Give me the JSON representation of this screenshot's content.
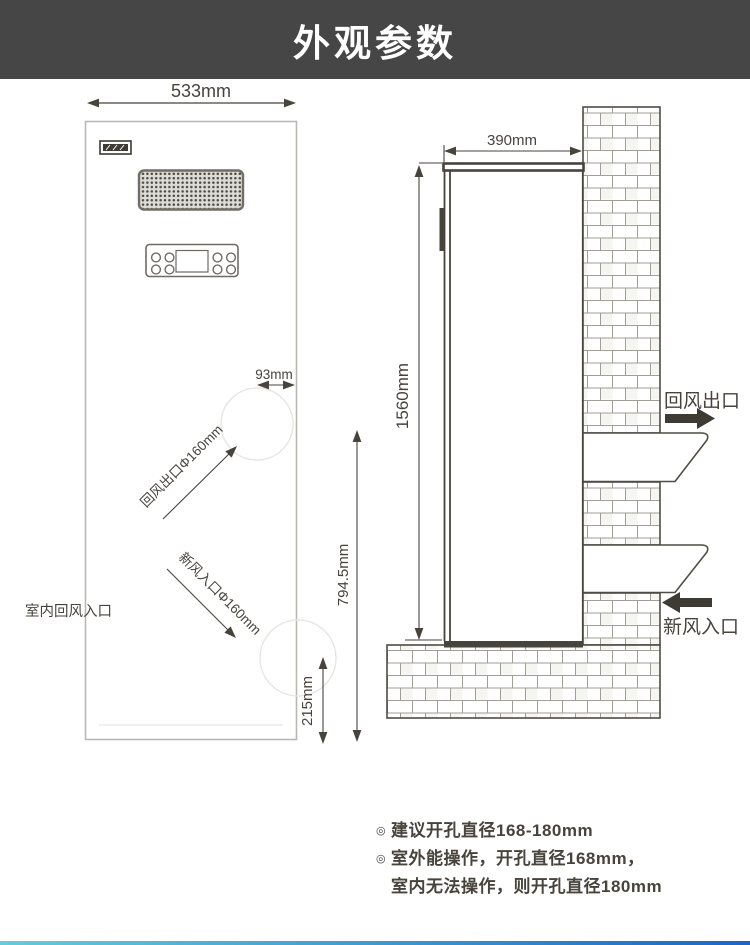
{
  "header": {
    "title": "外观参数"
  },
  "front_view": {
    "width_dim": "533mm",
    "hole_offset_dim": "93mm",
    "return_outlet_label": "回风出口Φ160mm",
    "fresh_inlet_label": "新风入口Φ160mm",
    "indoor_return_label": "室内回风入口",
    "hole_center_height_dim": "794.5mm",
    "bottom_hole_dim": "215mm"
  },
  "side_view": {
    "depth_dim": "390mm",
    "height_dim": "1560mm",
    "return_outlet_label": "回风出口",
    "fresh_inlet_label": "新风入口"
  },
  "notes": [
    {
      "bullet": "◎",
      "text": "建议开孔直径168-180mm"
    },
    {
      "bullet": "◎",
      "text": "室外能操作，开孔直径168mm，"
    },
    {
      "bullet": "",
      "text": "室内无法操作，则开孔直径180mm"
    }
  ],
  "colors": {
    "header_bg": "#464646",
    "line": "#47433d",
    "accent_gradient_start": "#66cbd9",
    "accent_gradient_end": "#1b66c5"
  }
}
